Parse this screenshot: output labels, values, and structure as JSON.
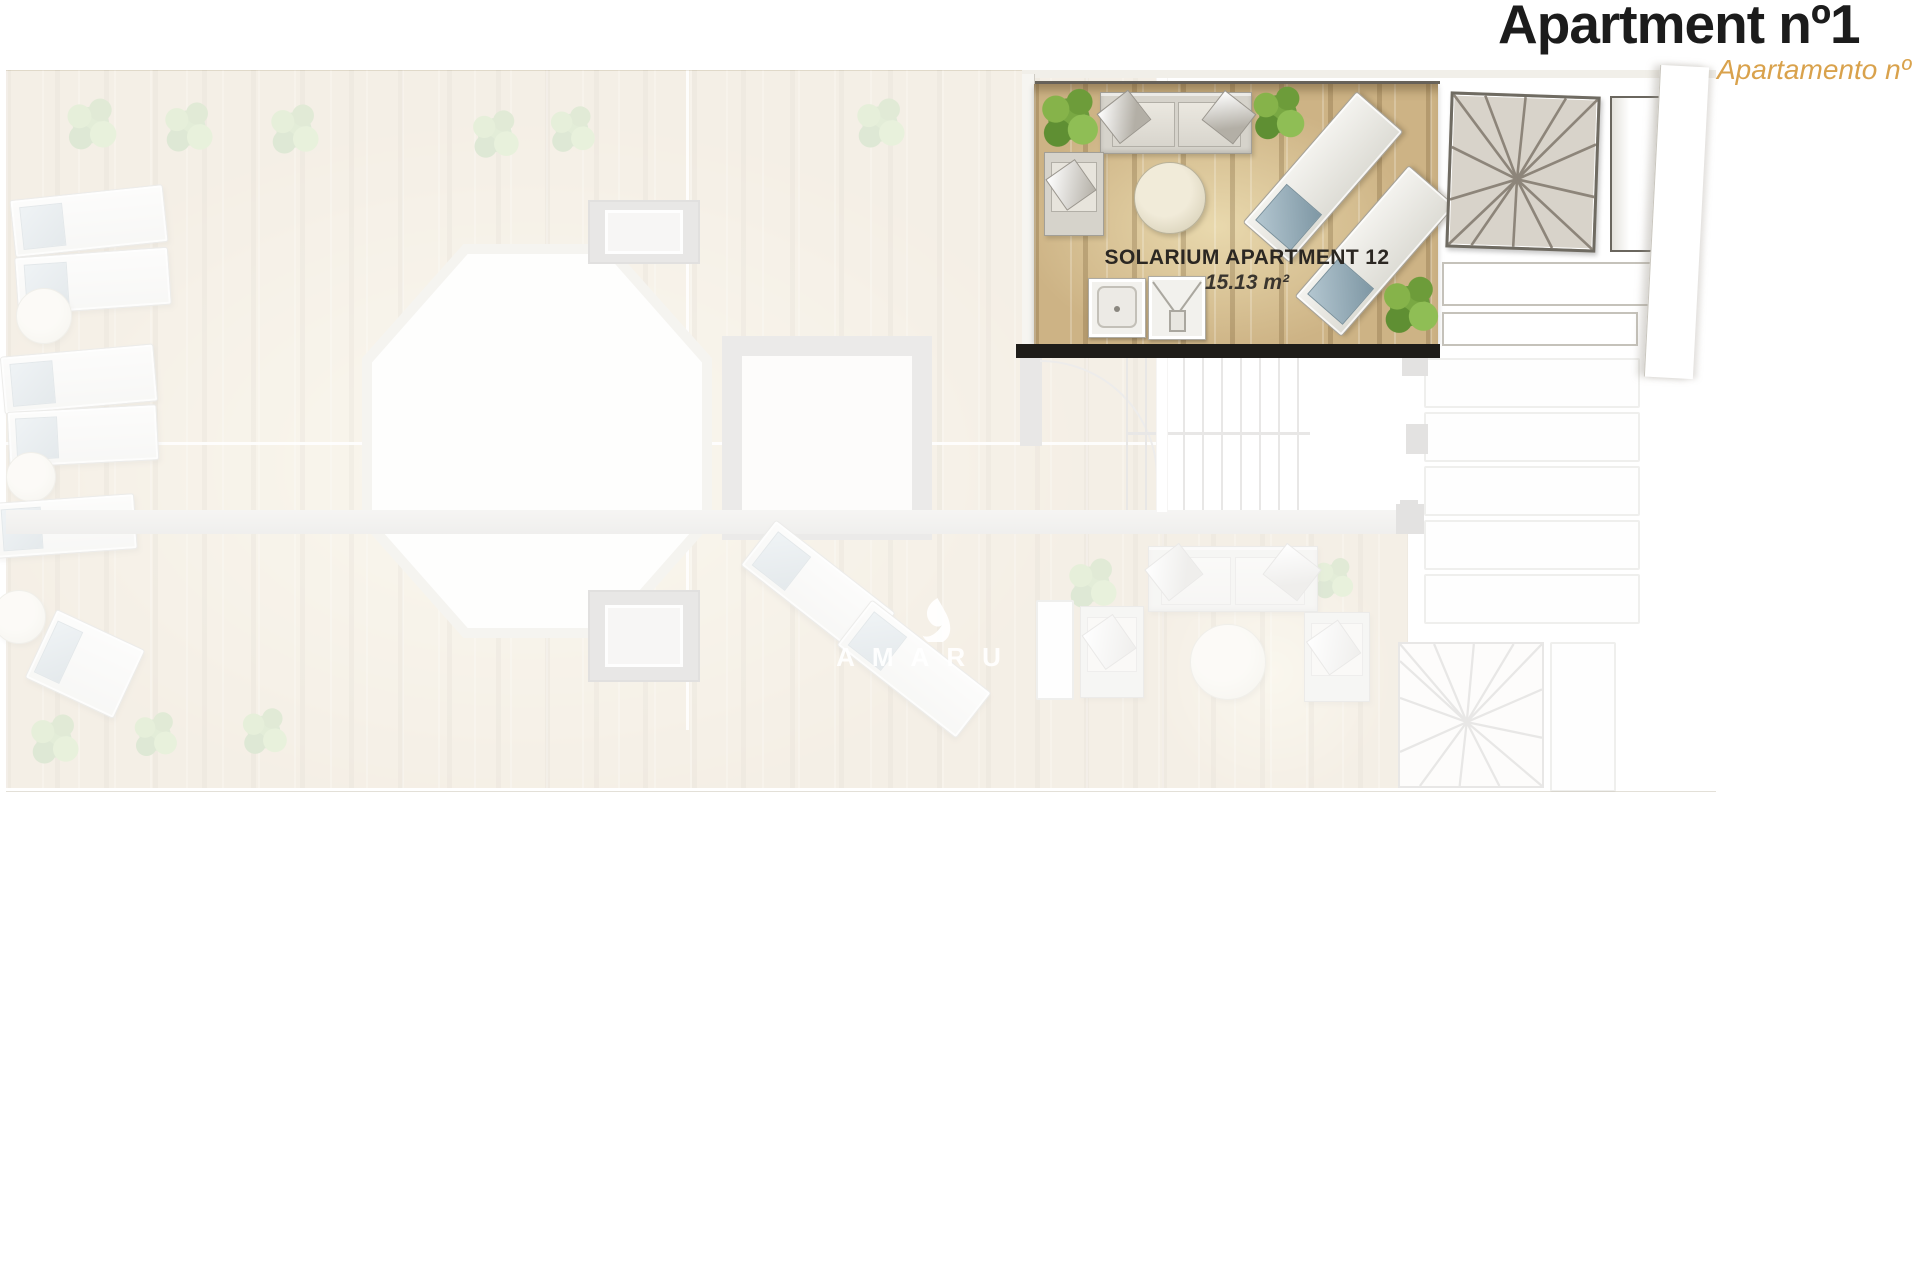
{
  "header": {
    "title": "Apartment nº1",
    "subtitle": "Apartamento nº"
  },
  "plan": {
    "highlight_room": {
      "label": "SOLARIUM APARTMENT 12",
      "area": "15.13 m²"
    },
    "watermark": "AMARU"
  },
  "colors": {
    "title_text": "#1c1c1c",
    "subtitle_orange": "#d9a24c",
    "room_label_text": "#2b2722",
    "wood_floor": "#cdb385",
    "highlight_wall_black": "#1f1d19",
    "plant_green": "#79a843",
    "lounger_cushion_blue": "#7e97a4",
    "washed_background": "#f5f0e7"
  }
}
